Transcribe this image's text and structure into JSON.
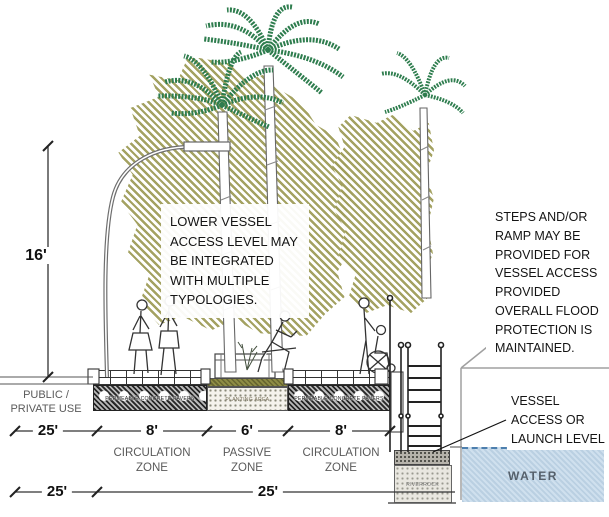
{
  "annotations": {
    "lower_vessel": "LOWER VESSEL ACCESS LEVEL MAY BE INTEGRATED WITH MULTIPLE TYPOLOGIES.",
    "steps_ramp": "STEPS AND/OR RAMP MAY BE PROVIDED FOR VESSEL ACCESS PROVIDED OVERALL FLOOD PROTECTION IS MAINTAINED.",
    "vessel_access": "VESSEL ACCESS OR LAUNCH LEVEL"
  },
  "labels": {
    "public_private_use": "PUBLIC / PRIVATE USE",
    "water": "WATER",
    "planting_area": "PLANTING AREA",
    "permeable_pavers": "PERMEABLE CONCRETE PAVERS",
    "riverrock": "RIVERROCK"
  },
  "dimensions": {
    "height": "16'",
    "top": [
      "25'",
      "8'",
      "6'",
      "8'"
    ],
    "bottom": [
      "25'",
      "25'"
    ]
  },
  "zones": [
    "CIRCULATION ZONE",
    "PASSIVE ZONE",
    "CIRCULATION ZONE"
  ],
  "colors": {
    "frond_green": "#2e7d4e",
    "canopy_olive": "#9c9a54",
    "water_fill": "#cfe0ee",
    "water_edge": "#4d7fae",
    "line_dark": "#222222",
    "label_gray": "#5a5a5a"
  }
}
